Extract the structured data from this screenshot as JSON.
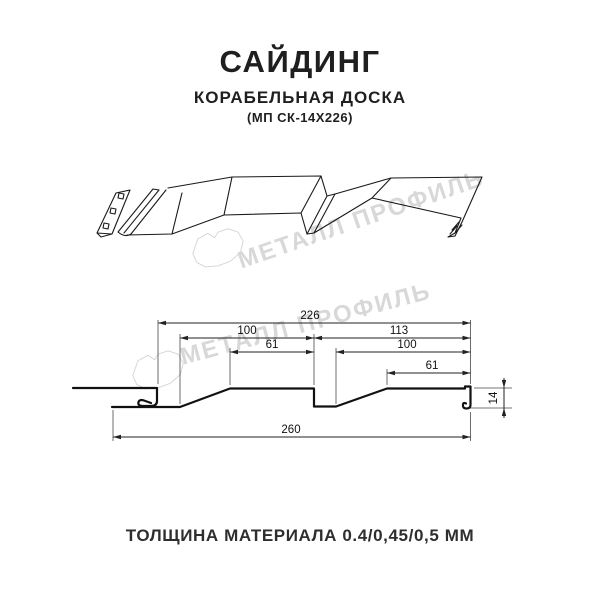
{
  "header": {
    "title": "САЙДИНГ",
    "subtitle": "КОРАБЕЛЬНАЯ ДОСКА",
    "model": "(МП СК-14Х226)"
  },
  "watermark": {
    "text": "МЕТАЛЛ ПРОФИЛЬ"
  },
  "footer": {
    "text": "ТОЛЩИНА МАТЕРИАЛА 0.4/0,45/0,5 ММ"
  },
  "drawing": {
    "dims": {
      "overall_top": "226",
      "left_width": "100",
      "left_face": "61",
      "right_width": "113",
      "right_mid": "100",
      "right_face": "61",
      "overall_bottom": "260",
      "height": "14"
    }
  },
  "colors": {
    "line": "#1a1a1a",
    "watermark": "#d8d8d8",
    "text": "#1f1f1f"
  }
}
